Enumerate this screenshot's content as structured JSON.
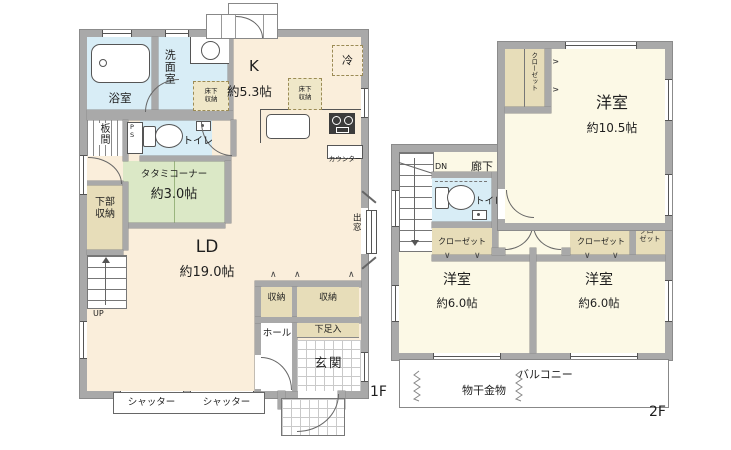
{
  "colors": {
    "wall": "#a9a9a9",
    "floor1_room": "#faeedb",
    "floor2_room": "#fcf9e6",
    "water_room": "#d8edf6",
    "tatami": "#dbe8c6",
    "storage": "#e7ddb9"
  },
  "floor1": {
    "label": "1F",
    "bath": "浴室",
    "washroom": "洗面室",
    "underfloor_storage": "床下収納",
    "kitchen": "K",
    "kitchen_size": "約5.3帖",
    "fridge": "冷",
    "counter": "カウンター",
    "itama": "板間",
    "pipe_space": "PS",
    "toilet": "トイレ",
    "tatami_corner": "タタミコーナー",
    "tatami_size": "約3.0帖",
    "lower_storage": "下部収納",
    "up": "UP",
    "living": "LD",
    "living_size": "約19.0帖",
    "storage": "収納",
    "hall": "ホール",
    "shoe_cabinet": "下足入",
    "entrance": "玄関",
    "shutter": "シャッター",
    "bay_window": "出窓"
  },
  "floor2": {
    "label": "2F",
    "closet": "クローゼット",
    "room": "洋室",
    "room_main_size": "約10.5帖",
    "room_size": "約6.0帖",
    "down": "DN",
    "corridor": "廊下",
    "toilet": "トイレ",
    "balcony": "バルコニー",
    "laundry_hardware": "物干金物"
  }
}
